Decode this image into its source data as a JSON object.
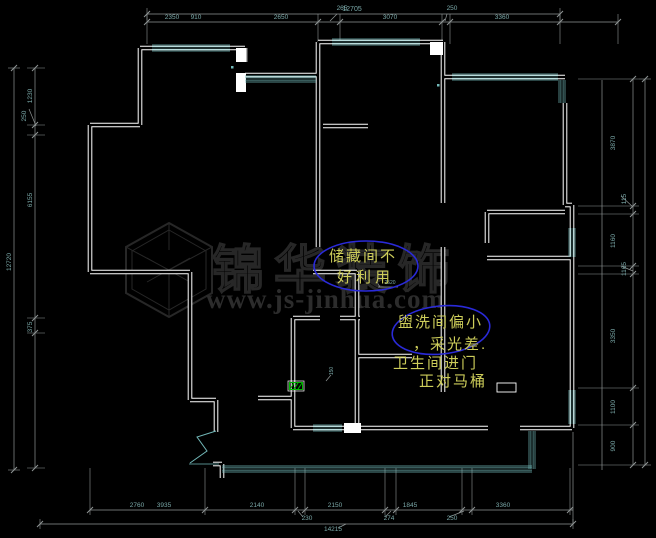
{
  "meta": {
    "drawing_type": "apartment floor plan (CAD)",
    "canvas": {
      "width": 656,
      "height": 538
    }
  },
  "colors": {
    "background": "#000000",
    "wall": "#ffffff",
    "window": "#72b8b8",
    "dim_line": "#909696",
    "dim_text": "#7aa8a8",
    "annotation_text": "#cdcd5a",
    "annotation_ellipse": "#2a2ad8",
    "watermark": "#272727",
    "green_marker": "#00b400"
  },
  "watermark": {
    "logo": "cube-logo",
    "brand": "锦华装饰",
    "url": "www.js-jinhua.com"
  },
  "annotations": [
    {
      "id": "storage-note",
      "lines": [
        "储藏间不",
        "好利用"
      ],
      "ellipse": {
        "cx": 366,
        "cy": 266,
        "rx": 52,
        "ry": 25,
        "rot": 0
      }
    },
    {
      "id": "washroom-note",
      "lines": [
        "盥洗间偏小",
        "，采光差.",
        "卫生间进门",
        "正对马桶"
      ],
      "ellipse": {
        "cx": 441,
        "cy": 330,
        "rx": 49,
        "ry": 24,
        "rot": -6
      }
    }
  ],
  "dimensions": {
    "lines": [
      {
        "o": "h",
        "pos": 14,
        "from": 147,
        "to": 560,
        "up": 6,
        "dn": 6,
        "ticks": [
          147,
          560
        ]
      },
      {
        "o": "h",
        "pos": 22,
        "from": 147,
        "to": 618,
        "up": 8,
        "dn": 22,
        "ticks": [
          147,
          318,
          340,
          442,
          450,
          560,
          618
        ]
      },
      {
        "o": "h",
        "pos": 510,
        "from": 90,
        "to": 573,
        "up": 42,
        "dn": 5,
        "ticks": [
          90,
          205,
          295,
          305,
          385,
          396,
          462,
          472,
          570
        ]
      },
      {
        "o": "h",
        "pos": 524,
        "from": 40,
        "to": 573,
        "up": 5,
        "dn": 5,
        "ticks": [
          40,
          573
        ]
      },
      {
        "o": "v",
        "pos": 14,
        "from": 68,
        "to": 470,
        "up": 6,
        "dn": 6,
        "ticks": [
          68,
          470
        ]
      },
      {
        "o": "v",
        "pos": 35,
        "from": 68,
        "to": 468,
        "up": 8,
        "dn": 10,
        "ticks": [
          68,
          125,
          135,
          318,
          333,
          468
        ]
      },
      {
        "o": "v",
        "pos": 633,
        "from": 79,
        "to": 465,
        "up": 55,
        "dn": 6,
        "ticks": [
          79,
          206,
          214,
          266,
          274,
          388,
          425,
          465
        ]
      },
      {
        "o": "v",
        "pos": 645,
        "from": 79,
        "to": 465,
        "up": 6,
        "dn": 6,
        "ticks": [
          79,
          465
        ]
      }
    ],
    "labels": [
      {
        "t": "12705",
        "x": 352,
        "y": 11,
        "r": 0,
        "s": 7
      },
      {
        "t": "2350",
        "x": 172,
        "y": 19,
        "r": 0,
        "s": 6.5
      },
      {
        "t": "910",
        "x": 196,
        "y": 19,
        "r": 0,
        "s": 6.5
      },
      {
        "t": "2650",
        "x": 281,
        "y": 19,
        "r": 0,
        "s": 6.5
      },
      {
        "t": "265",
        "x": 342,
        "y": 10,
        "r": 0,
        "s": 6.5
      },
      {
        "t": "3070",
        "x": 390,
        "y": 19,
        "r": 0,
        "s": 6.5
      },
      {
        "t": "250",
        "x": 452,
        "y": 10,
        "r": 0,
        "s": 6.5
      },
      {
        "t": "3360",
        "x": 502,
        "y": 19,
        "r": 0,
        "s": 6.5
      },
      {
        "t": "2760",
        "x": 137,
        "y": 507,
        "r": 0,
        "s": 6.5
      },
      {
        "t": "3935",
        "x": 164,
        "y": 507,
        "r": 0,
        "s": 6.5
      },
      {
        "t": "2140",
        "x": 257,
        "y": 507,
        "r": 0,
        "s": 6.5
      },
      {
        "t": "2150",
        "x": 335,
        "y": 507,
        "r": 0,
        "s": 6.5
      },
      {
        "t": "1845",
        "x": 410,
        "y": 507,
        "r": 0,
        "s": 6.5
      },
      {
        "t": "3360",
        "x": 503,
        "y": 507,
        "r": 0,
        "s": 6.5
      },
      {
        "t": "230",
        "x": 307,
        "y": 520,
        "r": 0,
        "s": 6.5
      },
      {
        "t": "274",
        "x": 389,
        "y": 520,
        "r": 0,
        "s": 6.5
      },
      {
        "t": "250",
        "x": 452,
        "y": 520,
        "r": 0,
        "s": 6.5
      },
      {
        "t": "14215",
        "x": 333,
        "y": 531,
        "r": 0,
        "s": 6.5
      },
      {
        "t": "12720",
        "x": 11,
        "y": 262,
        "r": -90,
        "s": 6.5
      },
      {
        "t": "1230",
        "x": 32,
        "y": 96,
        "r": -90,
        "s": 6.5
      },
      {
        "t": "250",
        "x": 26,
        "y": 116,
        "r": -90,
        "s": 6.5
      },
      {
        "t": "6155",
        "x": 32,
        "y": 200,
        "r": -90,
        "s": 6.5
      },
      {
        "t": "375",
        "x": 32,
        "y": 327,
        "r": -90,
        "s": 6.5
      },
      {
        "t": "3870",
        "x": 615,
        "y": 143,
        "r": -90,
        "s": 6.5
      },
      {
        "t": "115",
        "x": 626,
        "y": 199,
        "r": -90,
        "s": 6.5
      },
      {
        "t": "1160",
        "x": 615,
        "y": 241,
        "r": -90,
        "s": 6.5
      },
      {
        "t": "1165",
        "x": 626,
        "y": 269,
        "r": -90,
        "s": 6.5
      },
      {
        "t": "3350",
        "x": 615,
        "y": 336,
        "r": -90,
        "s": 6.5
      },
      {
        "t": "1100",
        "x": 615,
        "y": 407,
        "r": -90,
        "s": 6.5
      },
      {
        "t": "900",
        "x": 615,
        "y": 446,
        "r": -90,
        "s": 6.5
      },
      {
        "t": "2520",
        "x": 390,
        "y": 284,
        "r": 0,
        "s": 5
      },
      {
        "t": "150",
        "x": 333,
        "y": 371,
        "r": -90,
        "s": 5
      }
    ],
    "leaders": [
      [
        337,
        14,
        330,
        21
      ],
      [
        447,
        14,
        445,
        21
      ],
      [
        303,
        517,
        298,
        511
      ],
      [
        385,
        517,
        391,
        511
      ],
      [
        449,
        517,
        464,
        511
      ],
      [
        338,
        528,
        346,
        524
      ],
      [
        29,
        109,
        36,
        126
      ],
      [
        621,
        196,
        633,
        207
      ],
      [
        621,
        266,
        633,
        271
      ],
      [
        378,
        287,
        398,
        287
      ],
      [
        380,
        287,
        377,
        282
      ],
      [
        326,
        381,
        331,
        375
      ],
      [
        573,
        432,
        573,
        524
      ],
      [
        602,
        80,
        602,
        470
      ]
    ]
  },
  "plan": {
    "walls": [
      [
        140,
        48,
        245,
        48
      ],
      [
        140,
        48,
        140,
        125
      ],
      [
        90,
        125,
        140,
        125
      ],
      [
        90,
        125,
        90,
        272
      ],
      [
        90,
        272,
        190,
        272
      ],
      [
        190,
        272,
        190,
        400
      ],
      [
        190,
        400,
        216,
        400
      ],
      [
        216,
        400,
        216,
        432
      ],
      [
        258,
        398,
        293,
        398
      ],
      [
        293,
        318,
        293,
        428
      ],
      [
        293,
        428,
        345,
        428
      ],
      [
        361,
        428,
        488,
        428
      ],
      [
        520,
        428,
        572,
        428
      ],
      [
        318,
        42,
        318,
        247
      ],
      [
        318,
        42,
        443,
        42
      ],
      [
        443,
        42,
        443,
        203
      ],
      [
        443,
        77,
        565,
        77
      ],
      [
        565,
        103,
        565,
        205
      ],
      [
        565,
        205,
        572,
        205
      ],
      [
        572,
        205,
        572,
        428
      ],
      [
        487,
        212,
        565,
        212
      ],
      [
        487,
        212,
        487,
        243
      ],
      [
        487,
        258,
        572,
        258
      ],
      [
        313,
        272,
        357,
        272
      ],
      [
        357,
        272,
        357,
        318
      ],
      [
        293,
        318,
        320,
        318
      ],
      [
        340,
        318,
        360,
        318
      ],
      [
        357,
        318,
        357,
        428
      ],
      [
        357,
        356,
        412,
        356
      ],
      [
        443,
        247,
        443,
        392
      ],
      [
        323,
        126,
        368,
        126
      ],
      [
        245,
        48,
        245,
        62
      ],
      [
        245,
        75,
        318,
        75
      ],
      [
        213,
        464,
        222,
        464
      ],
      [
        222,
        464,
        222,
        478
      ]
    ],
    "pillars": [
      [
        236,
        48,
        10,
        14
      ],
      [
        236,
        73,
        10,
        19
      ],
      [
        344,
        423,
        17,
        10
      ],
      [
        430,
        42,
        13,
        13
      ]
    ],
    "windows": [
      [
        152,
        48,
        230,
        48
      ],
      [
        245,
        79,
        316,
        79
      ],
      [
        332,
        42,
        420,
        42
      ],
      [
        452,
        77,
        558,
        77
      ],
      [
        562,
        80,
        562,
        103
      ],
      [
        572,
        228,
        572,
        257
      ],
      [
        572,
        390,
        572,
        424
      ],
      [
        313,
        428,
        342,
        428
      ],
      [
        222,
        469,
        532,
        469
      ],
      [
        532,
        431,
        532,
        469
      ]
    ],
    "entry_door": [
      216,
      431,
      197,
      437,
      207,
      451,
      190,
      463
    ],
    "door_sill": [
      189,
      464,
      219,
      464
    ],
    "fixtures": [
      {
        "type": "rect",
        "name": "toilet",
        "x": 497,
        "y": 383,
        "w": 19,
        "h": 9
      }
    ],
    "green_marker": {
      "x": 288,
      "y": 381,
      "w": 16,
      "h": 10
    },
    "dots": [
      [
        231,
        66
      ],
      [
        437,
        84
      ]
    ]
  }
}
